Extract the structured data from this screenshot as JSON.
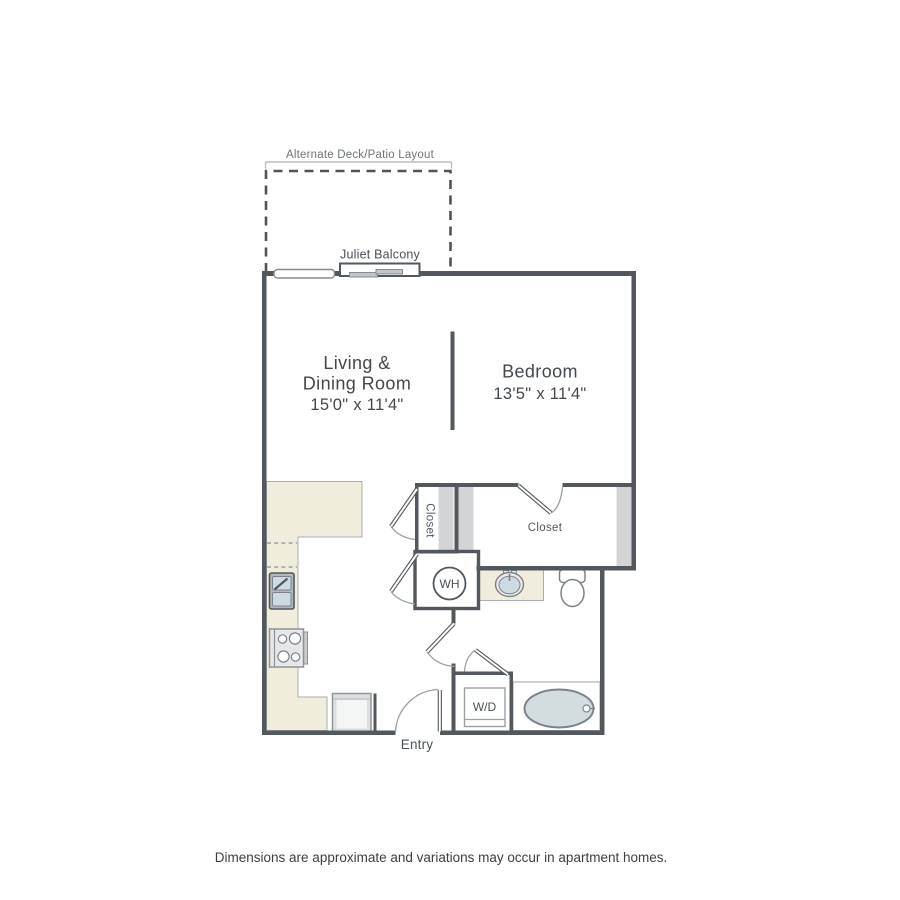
{
  "annotations": {
    "alternate_layout": "Alternate Deck/Patio Layout",
    "juliet_balcony": "Juliet Balcony",
    "entry": "Entry",
    "disclaimer": "Dimensions are approximate and variations may occur in apartment homes."
  },
  "rooms": {
    "living": {
      "name_line1": "Living &",
      "name_line2": "Dining Room",
      "dims": "15'0\" x 11'4\""
    },
    "bedroom": {
      "name": "Bedroom",
      "dims": "13'5\" x 11'4\""
    },
    "closet_small": {
      "name": "Closet"
    },
    "closet_large": {
      "name": "Closet"
    }
  },
  "fixtures": {
    "water_heater": "WH",
    "washer_dryer": "W/D"
  },
  "colors": {
    "wall": "#53585e",
    "counter": "#f0eddd",
    "closet_shelf": "#d3d4d6",
    "water_fixture": "#cfdce1",
    "text_dark": "#43484e",
    "text_gray": "#6e747a"
  }
}
